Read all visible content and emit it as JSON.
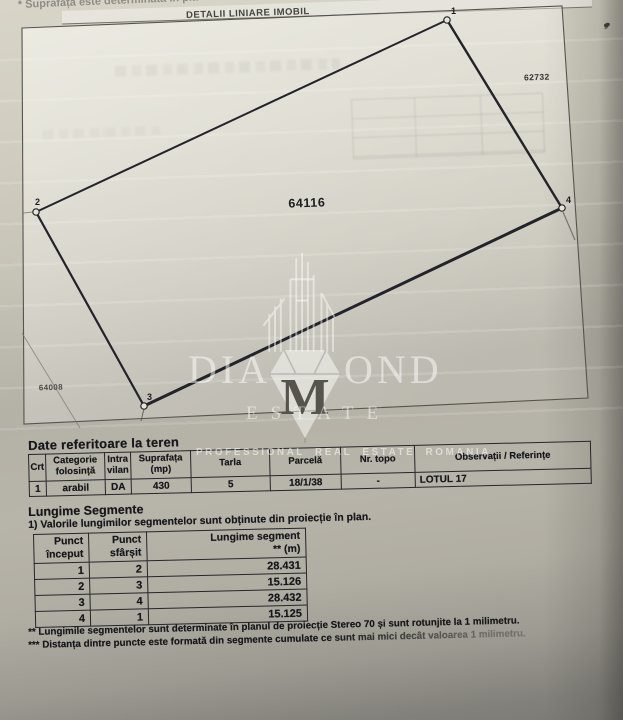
{
  "document": {
    "top_note_partial": "* Suprafața este determinată în pla",
    "section_title": "DETALII LINIARE IMOBIL"
  },
  "plot": {
    "parcel_label": "64116",
    "neighbor_parcel_right": "62732",
    "neighbor_parcel_left": "64008",
    "points": [
      {
        "id": "1",
        "x": 447,
        "y": 20
      },
      {
        "id": "2",
        "x": 36,
        "y": 212
      },
      {
        "id": "3",
        "x": 144,
        "y": 406
      },
      {
        "id": "4",
        "x": 562,
        "y": 208
      }
    ]
  },
  "watermark": {
    "brand_left": "DIA",
    "brand_middle_letter": "M",
    "brand_right": "OND",
    "brand_sub": "ESTATE",
    "tagline": "PROFESSIONAL REAL ESTATE ROMANIA"
  },
  "land_table": {
    "title": "Date referitoare la teren",
    "headers": [
      "Crt",
      "Categorie\nfolosință",
      "Intra\nvilan",
      "Suprafața\n(mp)",
      "Tarla",
      "Parcelă",
      "Nr. topo",
      "Observații / Referințe"
    ],
    "rows": [
      [
        "1",
        "arabil",
        "DA",
        "430",
        "5",
        "18/1/38",
        "-",
        "LOTUL 17"
      ]
    ]
  },
  "segments_table": {
    "title": "Lungime Segmente",
    "note": "1) Valorile lungimilor segmentelor sunt obținute din proiecție în plan.",
    "headers": [
      "Punct\nînceput",
      "Punct\nsfârșit",
      "Lungime segment\n** (m)"
    ],
    "rows": [
      [
        "1",
        "2",
        "28.431"
      ],
      [
        "2",
        "3",
        "15.126"
      ],
      [
        "3",
        "4",
        "28.432"
      ],
      [
        "4",
        "1",
        "15.125"
      ]
    ],
    "footnotes": [
      "** Lungimile segmentelor sunt determinate în planul de proiecție Stereo 70 și sunt rotunjite la 1 milimetru.",
      "*** Distanța dintre puncte este formată din segmente cumulate ce sunt mai mici decât valoarea 1 milimetru."
    ]
  },
  "colors": {
    "paper_light": "#d8d5c8",
    "paper_mid": "#b5b2a8",
    "paper_dark": "#7b7a74",
    "ink": "#17171b",
    "watermark_white": "rgba(253,253,250,0.52)"
  }
}
